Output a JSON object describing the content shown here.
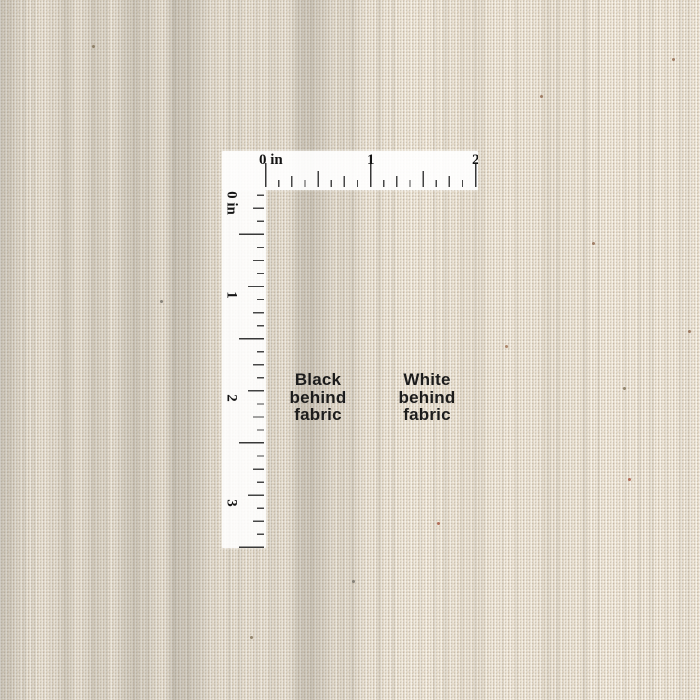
{
  "scene": {
    "description": "Close-up photo of natural cream handwoven fabric with an L-shaped inch ruler overlay used to show scale and opacity"
  },
  "colors": {
    "fabric_base": "#f1e9da",
    "fabric_streak": "#8c8676",
    "ruler_background": "#ffffff",
    "ruler_tick": "#3f3f3f",
    "ruler_number": "#141414",
    "annotation_text": "#1c1c1c"
  },
  "ruler": {
    "unit": "in",
    "horizontal_labels": [
      "0 in",
      "1",
      "2"
    ],
    "vertical_labels": [
      "0 in",
      "1",
      "2",
      "3"
    ]
  },
  "annotations": {
    "black_behind": {
      "line1": "Black",
      "line2": "behind",
      "line3": "fabric"
    },
    "white_behind": {
      "line1": "White",
      "line2": "behind",
      "line3": "fabric"
    }
  }
}
